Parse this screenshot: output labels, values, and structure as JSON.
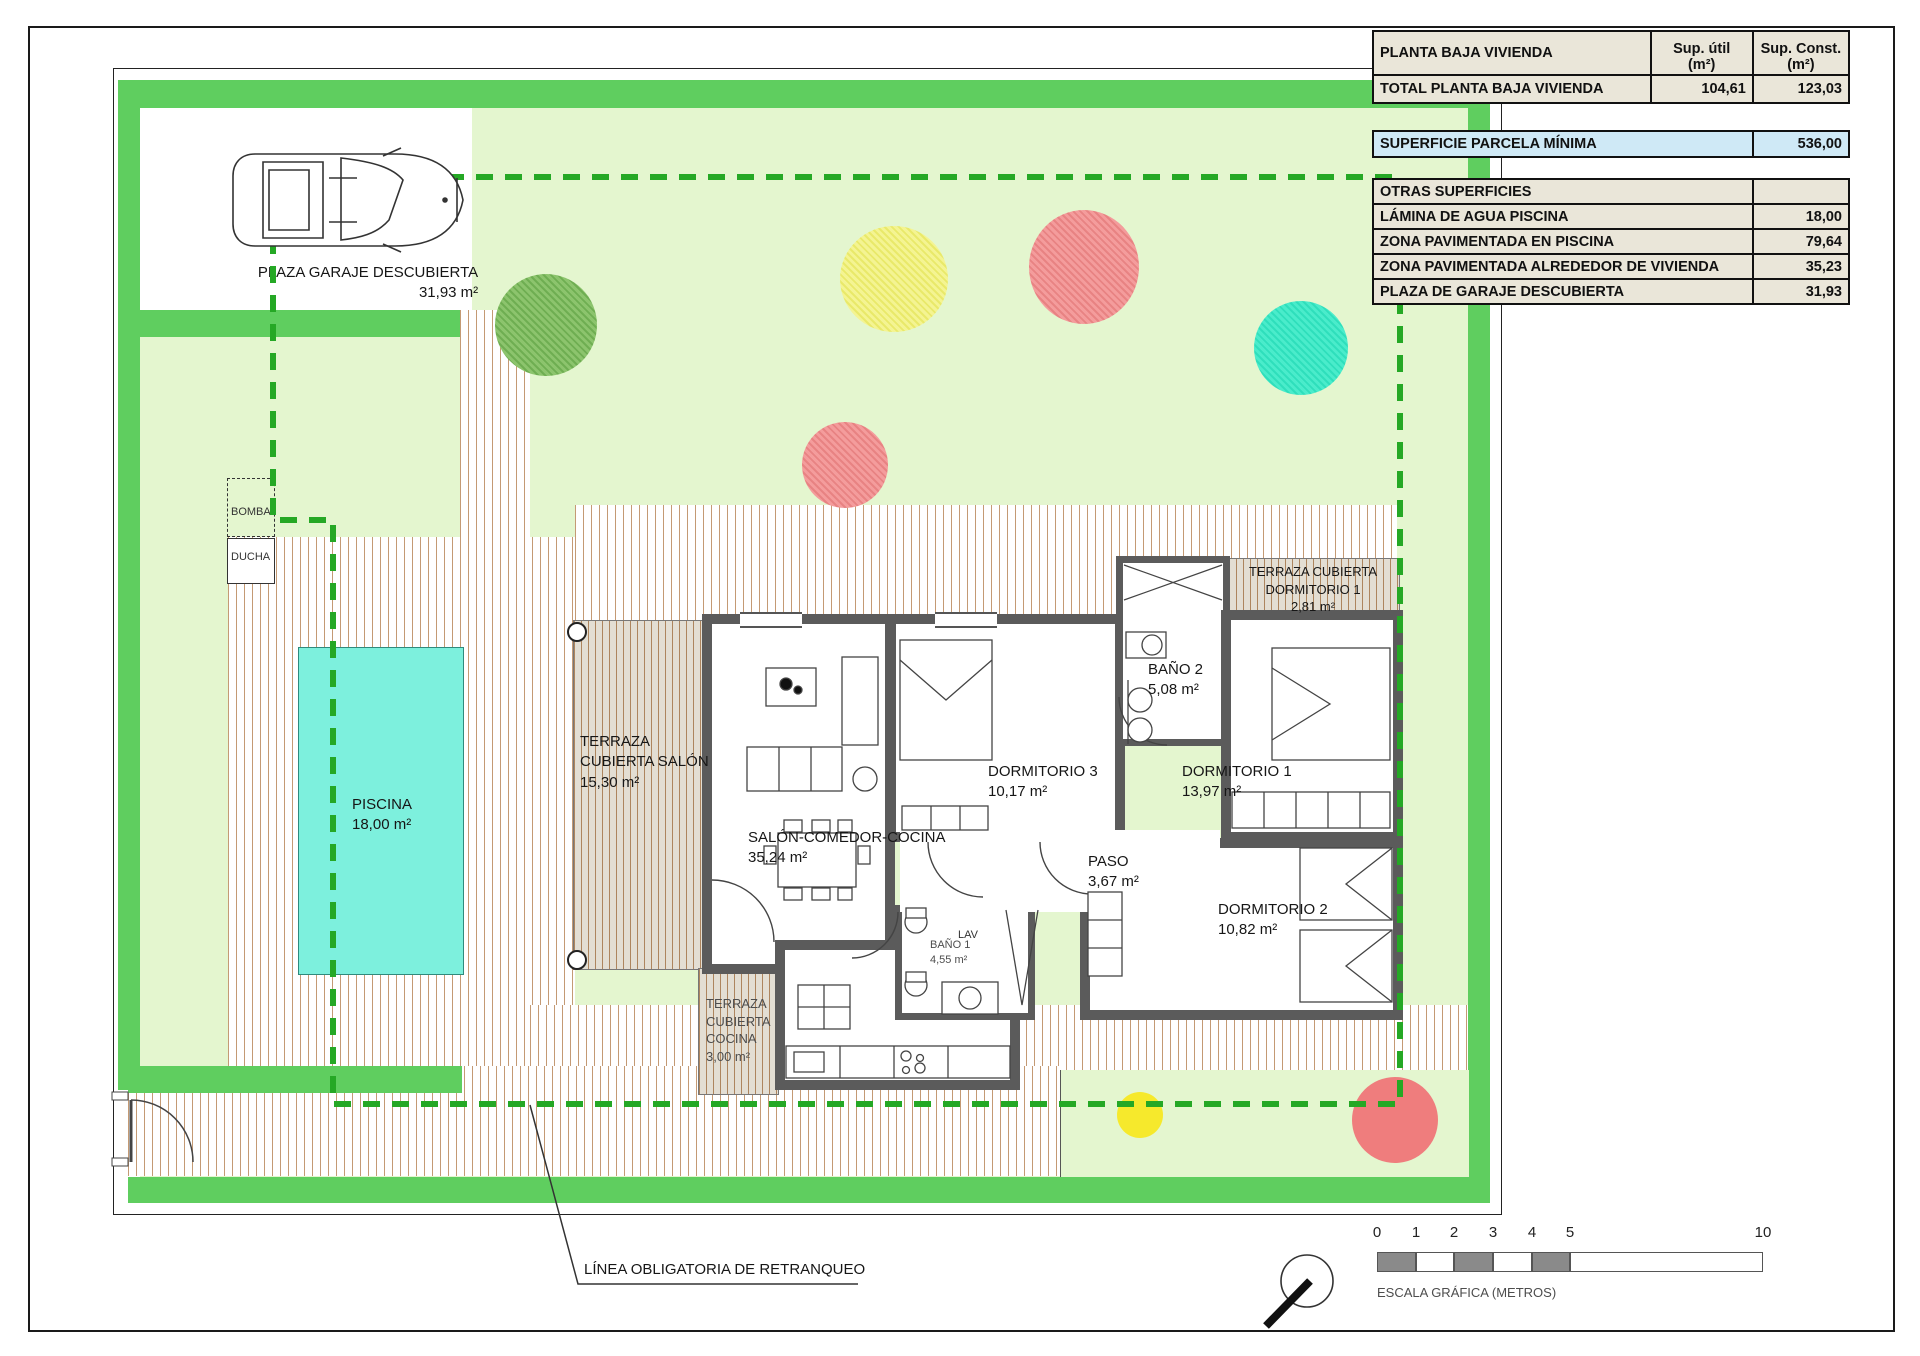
{
  "table": {
    "header": {
      "label": "PLANTA BAJA VIVIENDA",
      "util_1": "Sup. útil",
      "util_2": "(m²)",
      "const_1": "Sup. Const.",
      "const_2": "(m²)"
    },
    "total_row": {
      "label": "TOTAL PLANTA BAJA VIVIENDA",
      "util": "104,61",
      "const": "123,03"
    },
    "parcela_row": {
      "label": "SUPERFICIE PARCELA MÍNIMA",
      "value": "536,00"
    },
    "otras": {
      "title": "OTRAS SUPERFICIES",
      "rows": [
        {
          "label": "LÁMINA DE AGUA PISCINA",
          "value": "18,00"
        },
        {
          "label": "ZONA PAVIMENTADA EN PISCINA",
          "value": "79,64"
        },
        {
          "label": "ZONA PAVIMENTADA ALREDEDOR DE VIVIENDA",
          "value": "35,23"
        },
        {
          "label": "PLAZA DE GARAJE DESCUBIERTA",
          "value": "31,93"
        }
      ]
    }
  },
  "plan": {
    "garage": {
      "name": "PLAZA GARAJE DESCUBIERTA",
      "area": "31,93 m²"
    },
    "bomba": "BOMBA",
    "ducha": "DUCHA",
    "piscina": {
      "name": "PISCINA",
      "area": "18,00 m²"
    },
    "terraza_salon": {
      "l1": "TERRAZA",
      "l2": "CUBIERTA SALÓN",
      "area": "15,30 m²"
    },
    "salon": {
      "name": "SALÓN-COMEDOR-COCINA",
      "area": "35,24 m²"
    },
    "dorm3": {
      "name": "DORMITORIO 3",
      "area": "10,17 m²"
    },
    "bano2": {
      "name": "BAÑO 2",
      "area": "5,08 m²"
    },
    "dorm1": {
      "name": "DORMITORIO 1",
      "area": "13,97 m²"
    },
    "terraza_dorm1": {
      "l1": "TERRAZA CUBIERTA",
      "l2": "DORMITORIO 1",
      "area": "2,81 m²"
    },
    "paso": {
      "name": "PASO",
      "area": "3,67 m²"
    },
    "lav": "LAV",
    "bano1": {
      "name": "BAÑO 1",
      "area": "4,55 m²"
    },
    "dorm2": {
      "name": "DORMITORIO 2",
      "area": "10,82 m²"
    },
    "terraza_cocina": {
      "l1": "TERRAZA",
      "l2": "CUBIERTA",
      "l3": "COCINA",
      "area": "3,00 m²"
    },
    "retranqueo": "LÍNEA OBLIGATORIA DE RETRANQUEO"
  },
  "scalebar": {
    "ticks": [
      "0",
      "1",
      "2",
      "3",
      "4",
      "5",
      "10"
    ],
    "caption": "ESCALA GRÁFICA (METROS)"
  },
  "colors": {
    "hedge_green": "#5fce5f",
    "garden_green": "#e4f6cf",
    "setback_green": "#25a825",
    "pool_cyan": "#7df0dd",
    "wall_gray": "#5b5b5b",
    "table_beige": "#eae6d9",
    "table_blue": "#cfe9f6"
  }
}
